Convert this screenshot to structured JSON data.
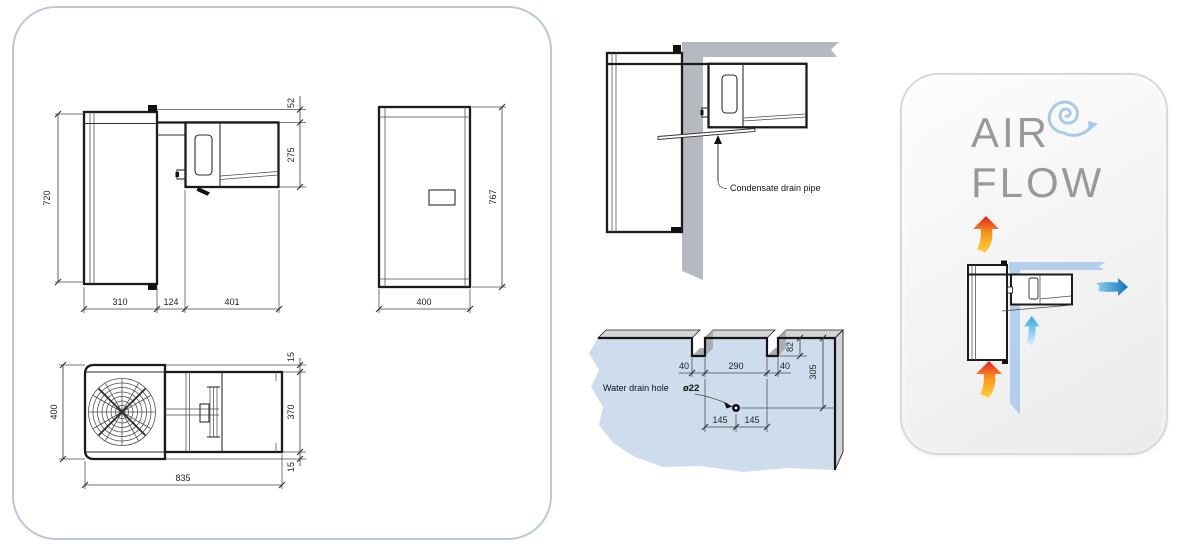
{
  "dimensions_panel": {
    "side_view": {
      "height": "720",
      "top_gap": "52",
      "condenser_height": "275",
      "evaporator_depth": "310",
      "wall_gap": "124",
      "condenser_depth": "401"
    },
    "front_view": {
      "height": "767",
      "width": "400"
    },
    "top_view": {
      "width": "400",
      "top_margin": "15",
      "condenser_width": "370",
      "bottom_margin": "15",
      "length": "835"
    }
  },
  "condensate_diagram": {
    "label": "Condensate drain pipe"
  },
  "wall_cutout_diagram": {
    "label": "Water drain hole",
    "hole_diameter": "ø22",
    "notch_left": "40",
    "notch_span": "290",
    "notch_right": "40",
    "notch_depth": "82",
    "hole_drop": "305",
    "hole_left": "145",
    "hole_right": "145"
  },
  "airflow_panel": {
    "title_line1": "AIR",
    "title_line2": "FLOW"
  },
  "colors": {
    "panel_border": "#bac7db",
    "wall_gray": "#b6bac0",
    "wall_top_gray": "#d3d4d6",
    "notch_shade": "#aaadb2",
    "wall_blue": "#cdddee",
    "ceiling_blue": "#b3cfeb",
    "title_gray": "#97999b",
    "swirl_blue": "#a9c9e8",
    "hot_top": "#e31e24",
    "hot_mid": "#f7941e",
    "hot_bottom": "#ffd23f",
    "cold_light": "#8ed1f2",
    "cold_dark": "#1173b8",
    "cyan_top": "#2fa8e1",
    "cyan_bottom": "#d9eefb"
  }
}
